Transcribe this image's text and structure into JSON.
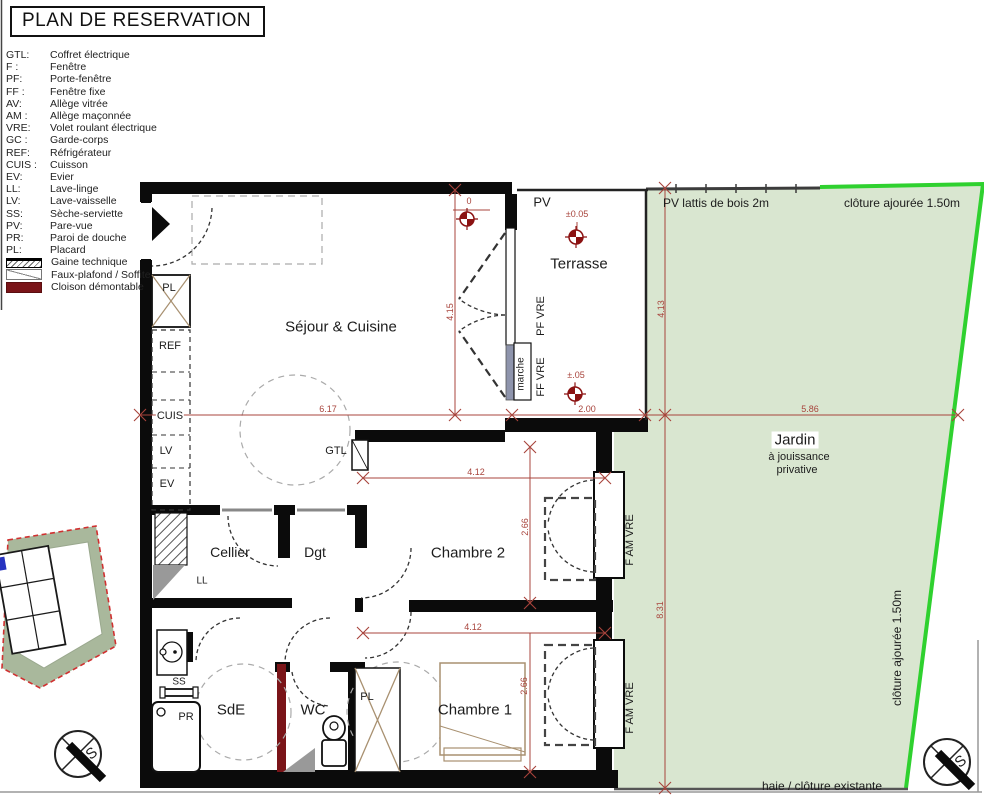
{
  "title": "PLAN DE RESERVATION",
  "legend": {
    "items": [
      {
        "abbr": "GTL:",
        "label": "Coffret électrique"
      },
      {
        "abbr": "F :",
        "label": "Fenêtre"
      },
      {
        "abbr": "PF:",
        "label": "Porte-fenêtre"
      },
      {
        "abbr": "FF :",
        "label": "Fenêtre fixe"
      },
      {
        "abbr": "AV:",
        "label": "Allège vitrée"
      },
      {
        "abbr": "AM :",
        "label": "Allège maçonnée"
      },
      {
        "abbr": "VRE:",
        "label": "Volet roulant électrique"
      },
      {
        "abbr": "GC :",
        "label": "Garde-corps"
      },
      {
        "abbr": "REF:",
        "label": "Réfrigérateur"
      },
      {
        "abbr": "CUIS :",
        "label": "Cuisson"
      },
      {
        "abbr": "EV:",
        "label": "Evier"
      },
      {
        "abbr": "LL:",
        "label": "Lave-linge"
      },
      {
        "abbr": "LV:",
        "label": "Lave-vaisselle"
      },
      {
        "abbr": "SS:",
        "label": "Sèche-serviette"
      },
      {
        "abbr": "PV:",
        "label": "Pare-vue"
      },
      {
        "abbr": "PR:",
        "label": "Paroi de douche"
      },
      {
        "abbr": "PL:",
        "label": "Placard"
      }
    ],
    "swatches": [
      {
        "label": "Gaine technique"
      },
      {
        "label": "Faux-plafond / Soffite"
      },
      {
        "label": "Cloison démontable"
      }
    ]
  },
  "rooms": {
    "sejour": "Séjour & Cuisine",
    "terrasse": "Terrasse",
    "cellier": "Cellier",
    "dgt": "Dgt",
    "chambre2": "Chambre 2",
    "sde": "SdE",
    "wc": "WC",
    "chambre1": "Chambre 1",
    "jardin": "Jardin",
    "jardin_sub1": "à jouissance",
    "jardin_sub2": "privative"
  },
  "labels": {
    "pv": "PV",
    "pl_top": "PL",
    "ref": "REF",
    "cuis": "CUIS",
    "lv": "LV",
    "ev": "EV",
    "gtl": "GTL",
    "ll": "LL",
    "ss": "SS",
    "pr": "PR",
    "pl_bottom": "PL",
    "marche": "marche",
    "pf_vre": "PF VRE",
    "ff_vre": "FF VRE",
    "f_am_vre_upper": "F AM VRE",
    "f_am_vre_lower": "F AM VRE"
  },
  "boundaries": {
    "pv_lattis": "PV lattis de bois 2m",
    "cloture_top": "clôture ajourée 1.50m",
    "cloture_right": "clôture ajourée 1.50m",
    "haie": "haie / clôture existante"
  },
  "dimensions": {
    "sejour_w": "6.17",
    "terrasse_w": "2.00",
    "jardin_w": "5.86",
    "sejour_h": "4.15",
    "jardin_h_top": "4.13",
    "jardin_h_bottom": "8.31",
    "chambre2_w": "4.12",
    "chambre2_h": "2.66",
    "chambre1_w": "4.12",
    "chambre1_h": "2.66"
  },
  "levels": {
    "zero": "0",
    "terrasse_high": "±0.05",
    "terrasse_low": "±.05"
  },
  "compass": {
    "letter": "S"
  },
  "colors": {
    "dimension_red": "#a8443c",
    "level_marker_red": "#8b1212",
    "cloison_demontable": "#7a1418",
    "garden_fill": "#d9e6d0",
    "garden_fence_green": "#2fd12f",
    "site_plan_band": "#a9b89c",
    "site_plan_boundary_red": "#d03030",
    "furniture_tan": "#a89070"
  }
}
